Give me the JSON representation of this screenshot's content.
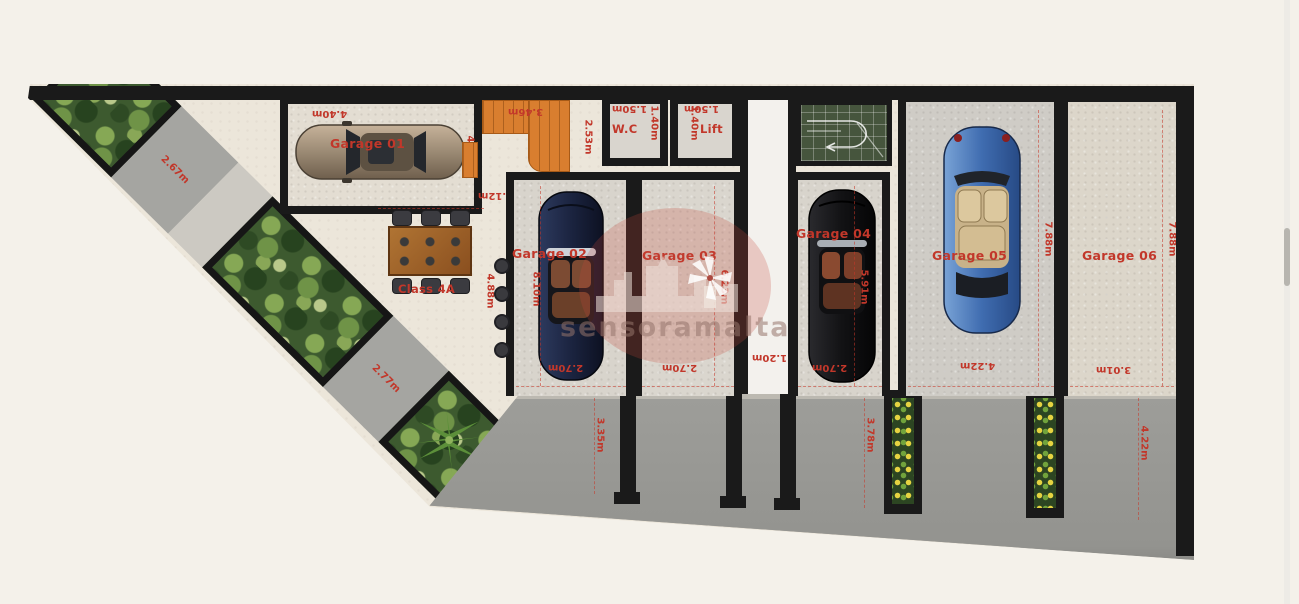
{
  "watermark": {
    "text": "sensoramalta"
  },
  "garages": [
    {
      "label": "Garage 01",
      "dim_width": "4.40m",
      "dim_depth": "4.70m"
    },
    {
      "label": "Garage 02",
      "dim_depth": "8.10m",
      "dim_width": "2.70m",
      "dim_outer": "4.88m"
    },
    {
      "label": "Garage 03",
      "dim_depth": "6.23m",
      "dim_width": "2.70m"
    },
    {
      "label": "Garage 04",
      "dim_depth": "5.91m",
      "dim_width": "2.70m"
    },
    {
      "label": "Garage 05",
      "dim_depth": "7.88m",
      "dim_width": "4.22m"
    },
    {
      "label": "Garage 06",
      "dim_depth": "7.88m",
      "dim_width": "3.01m"
    }
  ],
  "rooms": {
    "wc": {
      "label": "W.C",
      "dim_top": "1.50m",
      "dim_side": "1.40m"
    },
    "lift": {
      "label": "Lift",
      "dim_top": "1.50m",
      "dim_side": "1.40m"
    },
    "stairs": {
      "dim_top": "3.46m",
      "dim_side": "2.53m",
      "dim_bottom": "1.12m"
    },
    "corridor": {
      "dim_width": "1.20m"
    },
    "dining": {
      "label": "Class 4A"
    }
  },
  "paths": {
    "path1_dim": "2.67m",
    "path2_dim": "2.77m"
  },
  "street": {
    "dim_left": "3.35m",
    "dim_mid": "3.78m",
    "dim_right": "4.22m"
  },
  "colors": {
    "dim_red": "#c2372a",
    "wall": "#1a1a1a",
    "street_gray": "#9d9d99",
    "ramp_green": "#46553d",
    "stairs_orange": "#d97e2f"
  }
}
